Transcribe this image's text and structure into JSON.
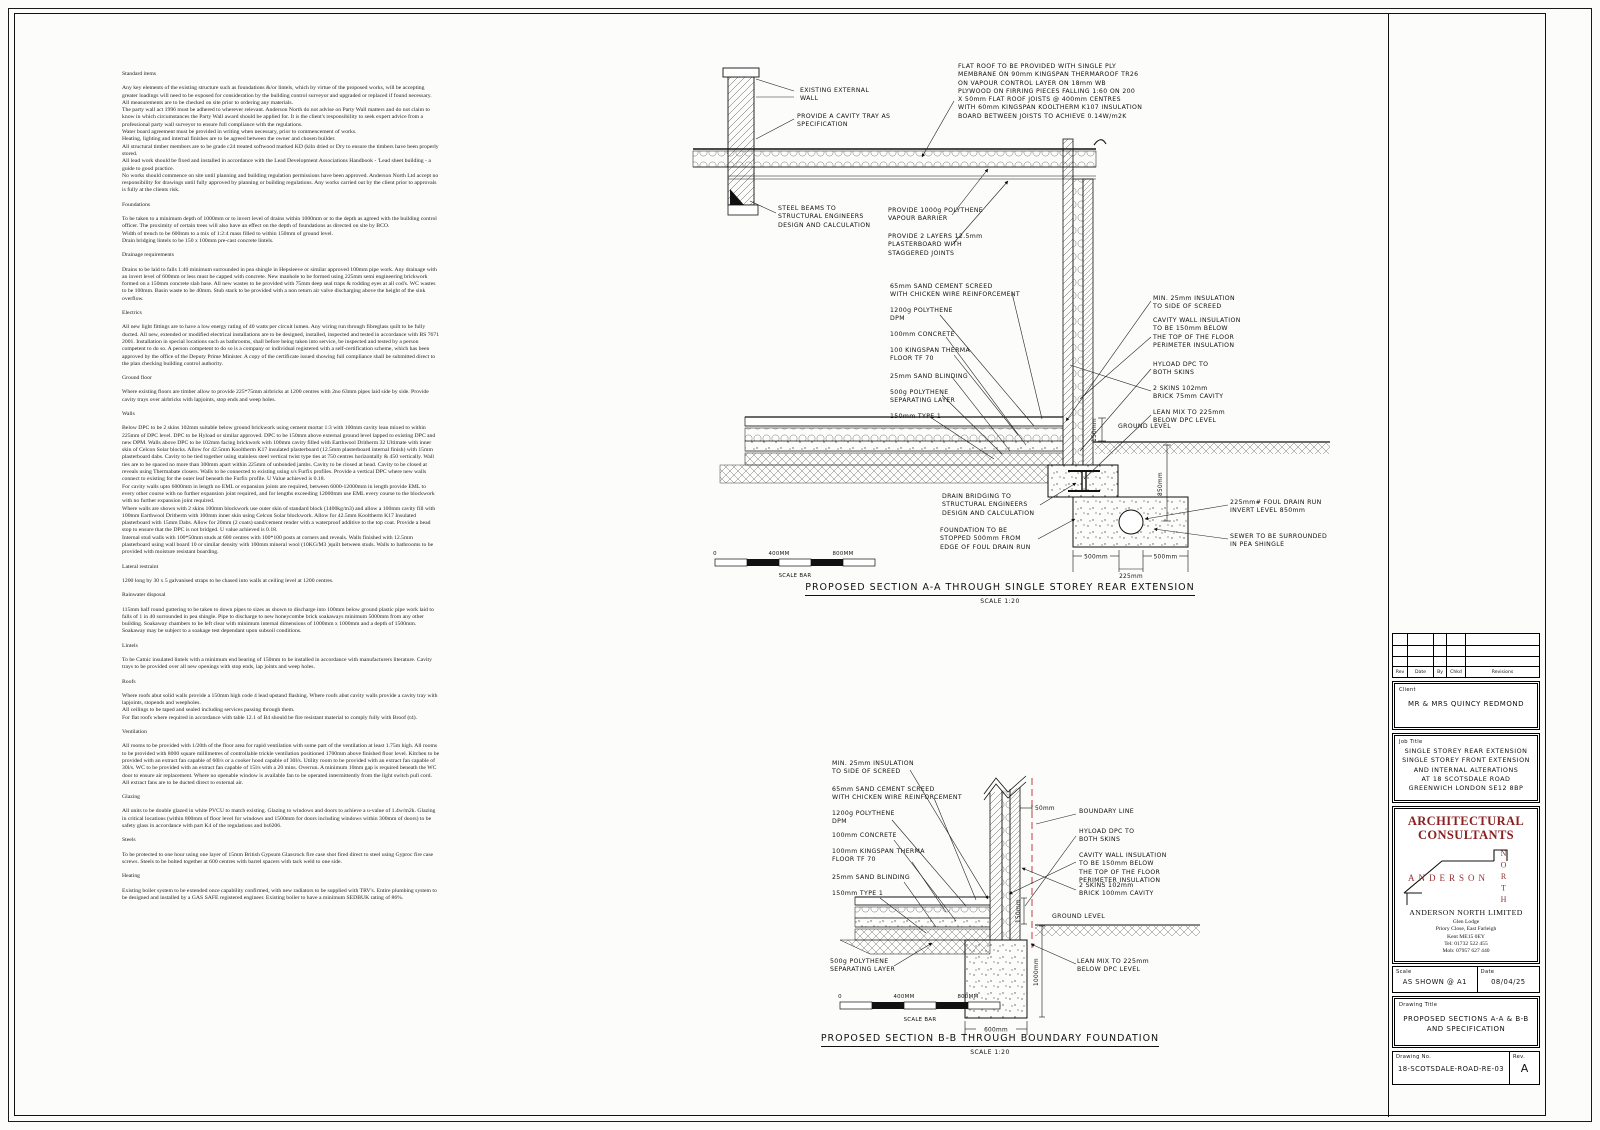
{
  "spec": {
    "sections": [
      {
        "title": "Standard items",
        "body": "Any key elements of the existing structure such as foundations &/or lintels, which by virtue of the proposed works, will be accepting greater loadings will need to be exposed for consideration by the building control surveyor and upgraded or replaced if found necessary.\nAll measurements are to be checked on site prior to ordering any materials.\nThe party wall act 1996 must be adhered to wherever relevant.  Anderson North do not advise on Party Wall matters and do not claim to know in which circumstances the Party Wall award should be applied for.  It is the client's responsibility to seek expert advice from a professional party wall surveyor to ensure full compliance with the regulations.\nWater board agreement must be provided in writing when necessary, prior to commencement of works.\nHeating, lighting and internal finishes are to be agreed between the owner and chosen builder.\nAll structural timber members are to be grade c24 treated softwood marked KD (kiln dried or Dry to ensure the timbers have been properly stored.\nAll lead work should be fixed and installed in accordance with the Lead Development Associations Handbook - 'Lead sheet building - a guide to good practice.\nNo works should commence on site until planning and building regulation permissions have been approved.  Anderson North Ltd accept no responsibility for drawings until fully approved by planning or building regulations.  Any works carried out by the client prior to approvals is fully at the clients risk."
      },
      {
        "title": "Foundations",
        "body": "To be taken to a minimum depth of 1000mm or to invert level of drains within 1000mm or to the depth as agreed with the building control officer.  The proximity of certain trees will also have an effect on the depth of foundations as directed on site by BCO.\nWidth of trench to be 600mm to a mix of 1:2:4 mass filled to within 150mm of ground level.\nDrain bridging lintels to be 150 x 100mm pre-cast concrete lintels."
      },
      {
        "title": "Drainage requirements",
        "body": "Drains to be laid to falls 1:40 minimum surrounded in pea shingle in Hepsleeve or similar approved 100mm pipe work. Any drainage with an invert level of 600mm or less must be capped with concrete.  New manhole to be formed using 225mm semi engineering brickwork formed on a 150mm concrete slab base.  All new wastes to be provided with 75mm deep seal traps & rodding eyes at all cod's.  WC wastes to be 100mm.  Basin waste to be 40mm.  Stub stack to be provided with a non return air valve discharging above the height of the sink overflow."
      },
      {
        "title": "Electrics",
        "body": "All new light fittings are to have a low energy rating of 40 watts per circuit lumen.  Any wiring run through fibreglass quilt to be fully ducted.  All new, extended or modified electrical installations are to be designed, installed, inspected and tested in accordance with BS 7671 2001.  Installation in special locations such as bathrooms, shall before being taken into service, be inspected and tested by a person competent to do so.  A person competent to do so is a company or individual registered with a self-certification scheme, which has been approved by the office of the Deputy Prime Minister.  A copy of the certificate issued showing full compliance shall be submitted direct to the plan checking building control authority."
      },
      {
        "title": "Ground floor",
        "body": "Where existing floors are timber allow to provide 225*75mm airbricks at 1200 centres with 2no 63mm pipes laid side by side.  Provide cavity trays over airbricks with lapjoints, stop ends and weep holes."
      },
      {
        "title": "Walls",
        "body": "Below DPC to be 2 skins 102mm suitable below ground brickwork using cement mortar 1:3 with 100mm cavity lean mixed to within 225mm of DPC level.  DPC to be Hyload or similar approved.  DPC to be 150mm above external ground level lapped to existing DPC and new DPM.  Walls above DPC to be 102mm facing brickwork with 100mm cavity filled with Earthwool Dritherm 32 Ultimate with inner skin of Celcon Solar blocks.  Allow for 42.5mm Kooltherm K17 insulated plasterboard (12.5mm plasterboard internal finish) with 15mm plasterboard dabs.  Cavity to be tied together using stainless steel vertical twist type ties at 750 centres horizontally & 450 vertically.  Wall ties are to be spaced no more than 300mm apart within 225mm of unbonded jambs.  Cavity to be closed at head.  Cavity to be closed at reveals using Thermabate closers.  Walls to be connected to existing using s/s Furfix profiles.  Provide a vertical DPC where new walls connect to existing for the outer leaf beneath the Furfix profile.  U Value achieved is 0.18.\nFor cavity walls upto 6000mm in length no EML or expansion joints are required, between 6000-12000mm in length provide EML to every other course with no further expansion joint required, and for lengths exceeding 12000mm use EML every course to the blockwork with no further expansion joint required.\nWhere walls are shown with 2 skins 100mm blockwork use outer skin of standard block (1400kg/m3) and allow a 100mm cavity fill with 100mm Earthwool Dritherm with 100mm inner skin using Celcon Solar blockwork.  Allow for 42.5mm Kooltherm K17 Insulated plasterboard with 15mm Dabs.  Allow for 20mm (2 coats) sand/cement render with a waterproof additive to the top coat.  Provide a bead stop to ensure that the DPC is not bridged.  U value achieved is 0.18.\nInternal stud walls with 100*50mm studs at 600 centres with 100*100 posts at corners and reveals.  Walls finished with 12.5mm plasterboard using wall board 10 or similar density with 100mm mineral wool (10KG/M3 )quilt between studs.  Walls to bathrooms to be provided with moisture resistant boarding."
      },
      {
        "title": "Lateral restraint",
        "body": "1200 long by 30 x 5 galvanised straps to be chased into walls at ceiling level at 1200 centres."
      },
      {
        "title": "Rainwater disposal",
        "body": "115mm half round guttering to be taken to down pipes to sizes as shown to discharge into 100mm below ground plastic pipe work laid to falls of 1 in 40 surrounded in pea shingle.  Pipe to discharge to new honeycombe brick soakaways minimum 5000mm from any other building.  Soakaway chambers to be left clear with minimum internal dimensions of 1000mm x 1000mm and a depth of 1500mm.  Soakaway may be subject to a soakage test dependant upon subsoil conditions."
      },
      {
        "title": "Lintels",
        "body": "To be Catnic insulated lintels with a minimum end bearing of 150mm to be installed in accordance with manufacturers literature.  Cavity trays to be provided over all new openings with stop ends, lap joints and weep holes."
      },
      {
        "title": "Roofs",
        "body": "Where roofs abut solid walls provide a 150mm high code 4 lead upstand flashing.  Where roofs abut cavity walls provide a cavity tray with lapjoints, stopends and weepholes.\nAll ceilings to be taped and sealed including services passing through them.\nFor flat roofs where required in accordance with table 12.1 of B4 should be fire resistant material to comply fully with Broof (t4)."
      },
      {
        "title": "Ventilation",
        "body": "All rooms to be provided with 1/20th of the floor area for rapid ventilation with some part of the ventilation at least 1.75m high.  All rooms to be provided with 8000 square millimetres of controllable trickle ventilation positioned 1700mm above finished floor level.  Kitchen to be provided with an extract fan capable of 60l/s or a cooker hood capable of 30l/s.  Utility room to be provided with an extract fan capable of 30l/s.  WC to be provided with an extract fan capable of 15l/s with a 20 mins. Overrun.  A minimum 10mm gap is required beneath the WC door to ensure air replacement.  Where no openable window is available fan to be operated intermittently from the light switch pull cord.  All extract fans are to be ducted direct to external air."
      },
      {
        "title": "Glazing",
        "body": "All units to be double glazed in white PVCU to match existing. Glazing to windows and doors to achieve a u-value of 1.4w/m2k.  Glazing in critical locations (within 800mm of floor level for windows and 1500mm for doors including windows within 300mm of doors) to be safety glass in accordance with part K4 of the regulations and bs6206."
      },
      {
        "title": "Steels",
        "body": "To be protected to one hour using one layer of 15mm British Gypsum Glassrock fire case shot fired direct to steel using Gyproc fire case screws.  Steels to be bolted together at 600 centres with barrel spacers with tack weld to one side."
      },
      {
        "title": "Heating",
        "body": "Existing boiler system to be extended once capability confirmed, with new radiators to be supplied with TRV's.  Entire plumbing system to be designed and installed by a GAS SAFE registered engineer.  Existing boiler to have a minimum SEDBUK rating of 86%."
      }
    ]
  },
  "section_a": {
    "labels": [
      "EXISTING EXTERNAL\nWALL",
      "PROVIDE A CAVITY TRAY AS\nSPECIFICATION",
      "FLAT ROOF TO BE PROVIDED WITH SINGLE PLY\nMEMBRANE ON 90mm KINGSPAN THERMAROOF TR26\nON VAPOUR CONTROL LAYER ON 18mm WB\nPLYWOOD ON FIRRING PIECES FALLING 1:60 ON 200\nX 50mm FLAT ROOF JOISTS @ 400mm CENTRES\nWITH 60mm KINGSPAN KOOLTHERM K107 INSULATION\nBOARD BETWEEN JOISTS TO ACHIEVE 0.14W/m2K",
      "STEEL BEAMS TO\nSTRUCTURAL ENGINEERS\nDESIGN AND CALCULATION",
      "PROVIDE 1000g POLYTHENE\nVAPOUR BARRIER",
      "PROVIDE 2 LAYERS 12.5mm\nPLASTERBOARD WITH\nSTAGGERED JOINTS",
      "65mm SAND CEMENT SCREED\nWITH CHICKEN WIRE REINFORCEMENT",
      "1200g POLYTHENE\nDPM",
      "100mm CONCRETE",
      "100 KINGSPAN THERMA\nFLOOR TF 70",
      "25mm SAND BLINDING",
      "500g POLYTHENE\nSEPARATING LAYER",
      "150mm TYPE 1",
      "MIN. 25mm INSULATION\nTO SIDE OF SCREED",
      "CAVITY WALL INSULATION\nTO BE 150mm BELOW\nTHE TOP OF THE FLOOR\nPERIMETER INSULATION",
      "HYLOAD DPC TO\nBOTH SKINS",
      "2 SKINS 102mm\nBRICK 75mm CAVITY",
      "LEAN MIX TO 225mm\nBELOW DPC LEVEL",
      "GROUND LEVEL",
      "DRAIN BRIDGING TO\nSTRUCTURAL ENGINEERS\nDESIGN AND CALCULATION",
      "FOUNDATION TO BE\nSTOPPED 500mm FROM\nEDGE OF FOUL DRAIN RUN",
      "225mm# FOUL DRAIN RUN\nINVERT LEVEL 850mm",
      "SEWER TO BE SURROUNDED\nIN PEA SHINGLE"
    ],
    "dims": [
      "150mm",
      "850mm",
      "500mm",
      "500mm",
      "225mm"
    ],
    "scalebar": {
      "zero": "0",
      "mid": "400MM",
      "end": "800MM",
      "caption": "SCALE BAR"
    },
    "title": "PROPOSED SECTION A-A THROUGH SINGLE STOREY REAR EXTENSION",
    "scale": "SCALE 1:20"
  },
  "section_b": {
    "labels": [
      "MIN. 25mm INSULATION\nTO SIDE OF SCREED",
      "65mm SAND CEMENT SCREED\nWITH CHICKEN WIRE REINFORCEMENT",
      "1200g POLYTHENE\nDPM",
      "100mm CONCRETE",
      "100mm KINGSPAN THERMA\nFLOOR TF 70",
      "25mm SAND BLINDING",
      "150mm TYPE 1",
      "500g POLYTHENE\nSEPARATING LAYER",
      "BOUNDARY LINE",
      "HYLOAD DPC TO\nBOTH SKINS",
      "CAVITY WALL INSULATION\nTO BE 150mm BELOW\nTHE TOP OF THE FLOOR\nPERIMETER INSULATION",
      "2 SKINS 102mm\nBRICK 100mm CAVITY",
      "GROUND LEVEL",
      "LEAN MIX TO 225mm\nBELOW DPC LEVEL"
    ],
    "dims": [
      "50mm",
      "150mm",
      "1000mm",
      "600mm"
    ],
    "scalebar": {
      "zero": "0",
      "mid": "400MM",
      "end": "800MM",
      "caption": "SCALE BAR"
    },
    "title": "PROPOSED SECTION B-B THROUGH BOUNDARY FOUNDATION",
    "scale": "SCALE 1:20"
  },
  "titleblock": {
    "rev_headers": [
      "Rev",
      "Date",
      "By",
      "Chkd",
      "Revisions"
    ],
    "client_label": "Client",
    "client": "MR & MRS QUINCY REDMOND",
    "job_label": "Job Title",
    "job_title": "SINGLE STOREY REAR EXTENSION\nSINGLE STOREY FRONT EXTENSION\nAND INTERNAL ALTERATIONS\nAT 18 SCOTSDALE ROAD\nGREENWICH LONDON SE12 8BP",
    "firm_type": "ARCHITECTURAL\nCONSULTANTS",
    "logo_name": "ANDERSON",
    "logo_vertical": "NORTH",
    "company": "ANDERSON NORTH LIMITED",
    "address": "Glen Lodge\nPriory Close, East Farleigh\nKent ME15 0EY\nTel: 01732 522 455\nMob: 07957 627 440",
    "scale_label": "Scale",
    "scale": "AS SHOWN @ A1",
    "date_label": "Date",
    "date": "08/04/25",
    "title_label": "Drawing Title",
    "drawing_title": "PROPOSED SECTIONS A-A & B-B\nAND SPECIFICATION",
    "no_label": "Drawing No.",
    "drawing_no": "18-SCOTSDALE-ROAD-RE-03",
    "rev_label": "Rev.",
    "rev": "A"
  }
}
